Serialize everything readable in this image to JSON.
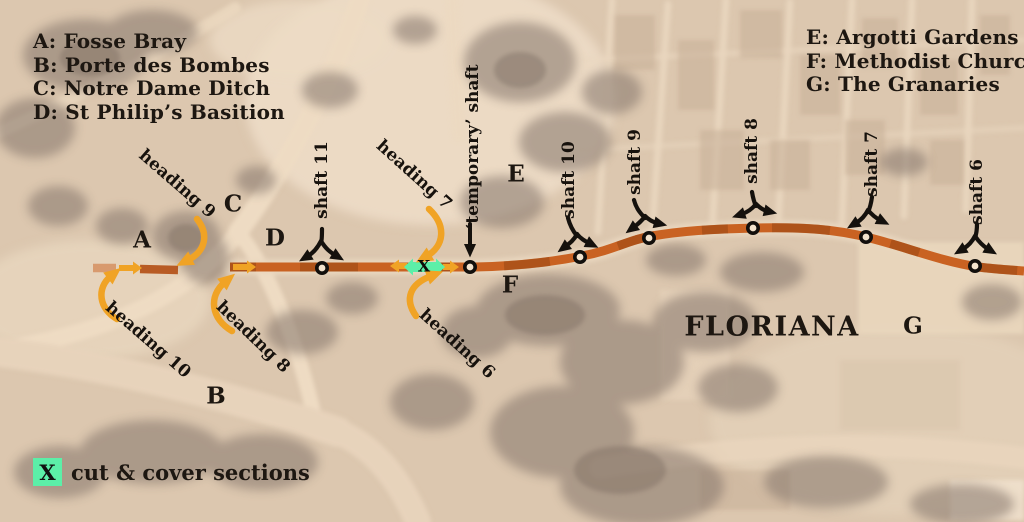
{
  "legend_left": {
    "items": [
      "A: Fosse Bray",
      "B: Porte des Bombes",
      "C: Notre Dame Ditch",
      "D: St Philip&#x2019;s Basition"
    ]
  },
  "legend_right": {
    "items": [
      "E: Argotti Gardens",
      "F: Methodist Church",
      "G: The Granaries"
    ]
  },
  "legend_cut_cover": {
    "symbol": "X",
    "label": "cut & cover sections"
  },
  "place": {
    "city": "FLORIANA"
  },
  "letters": {
    "a": "A",
    "b": "B",
    "c": "C",
    "d": "D",
    "e": "E",
    "f": "F",
    "g": "G"
  },
  "shafts": {
    "s11": "shaft 11",
    "temp": "‘temporary’ shaft",
    "s10": "shaft 10",
    "s9": "shaft 9",
    "s8": "shaft 8",
    "s7": "shaft 7",
    "s6": "shaft 6"
  },
  "headings": {
    "h9": "heading 9",
    "h10": "heading 10",
    "h8": "heading 8",
    "h7": "heading 7",
    "h6": "heading 6"
  },
  "route": {
    "cut_cover_mark": "X"
  },
  "colors": {
    "route_orange": "#c96222",
    "arrow_amber": "#f0a325",
    "mint_green": "#5cefa8",
    "ink": "#1d1711"
  }
}
